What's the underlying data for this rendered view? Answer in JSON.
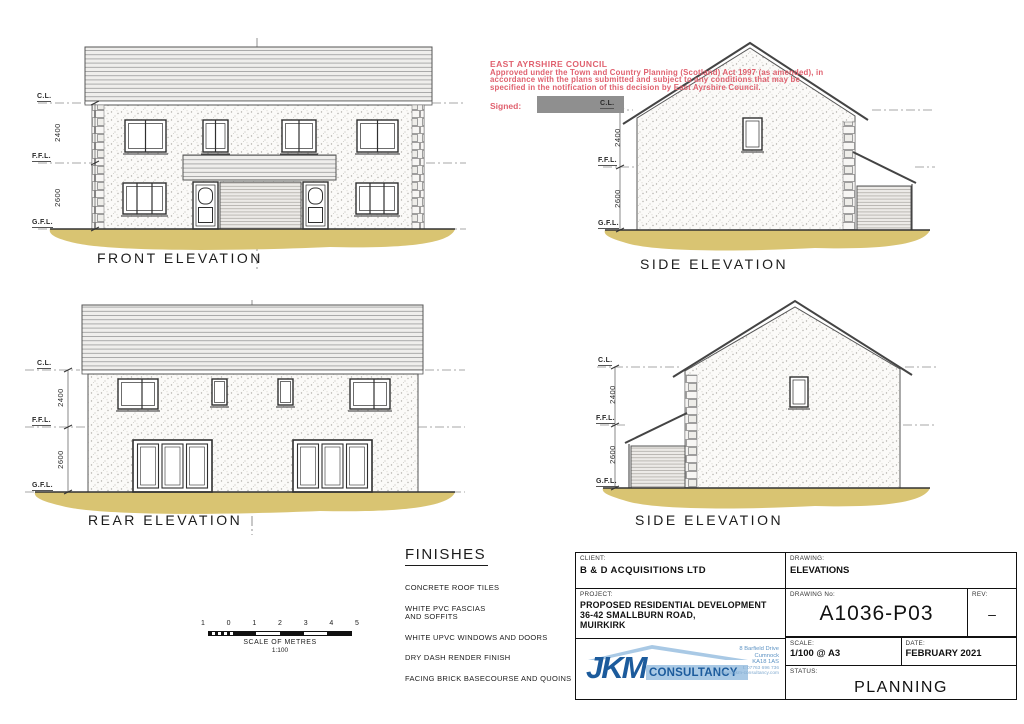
{
  "stamp": {
    "council": "EAST AYRSHIRE COUNCIL",
    "line1": "Approved under the Town and Country Planning (Scotland) Act 1997 (as amended), in",
    "line2": "accordance with the plans submitted and subject to any conditions that may be",
    "line3": "specified in the notification of this decision by East Ayrshire Council.",
    "signed_label": "Signed:"
  },
  "levels": {
    "cl": "C.L.",
    "ffl": "F.F.L.",
    "gfl": "G.F.L.",
    "dim_upper": "2400",
    "dim_lower": "2600"
  },
  "elevations": {
    "front": "FRONT ELEVATION",
    "side_top": "SIDE ELEVATION",
    "rear": "REAR ELEVATION",
    "side_bottom": "SIDE ELEVATION"
  },
  "finishes": {
    "title": "FINISHES",
    "items": [
      "CONCRETE ROOF TILES",
      "WHITE PVC FASCIAS\nAND SOFFITS",
      "WHITE UPVC WINDOWS AND DOORS",
      "DRY DASH RENDER FINISH",
      "FACING BRICK BASECOURSE AND QUOINS"
    ]
  },
  "scalebar": {
    "ticks": [
      "1",
      "0",
      "1",
      "2",
      "3",
      "4",
      "5"
    ],
    "caption": "SCALE OF METRES",
    "ratio": "1:100"
  },
  "titleblock": {
    "client_label": "CLIENT:",
    "client": "B & D ACQUISITIONS LTD",
    "drawing_label": "DRAWING:",
    "drawing": "ELEVATIONS",
    "project_label": "PROJECT:",
    "project_line1": "PROPOSED RESIDENTIAL DEVELOPMENT",
    "project_line2": "36-42 SMALLBURN ROAD,",
    "project_line3": "MUIRKIRK",
    "drawing_no_label": "DRAWING No:",
    "drawing_no": "A1036-P03",
    "rev_label": "REV:",
    "rev": "–",
    "scale_label": "SCALE:",
    "scale": "1/100 @ A3",
    "date_label": "DATE:",
    "date": "FEBRUARY 2021",
    "status_label": "STATUS:",
    "status": "PLANNING",
    "logo": {
      "jkm": "JKM",
      "consultancy": "CONSULTANCY",
      "addr1": "8 Barfield Drive",
      "addr2": "Cumnock",
      "addr3": "KA18 1AS",
      "addr4": "t: 07763 696 736",
      "addr5": "e: mail@jkm-consultancy.com"
    }
  },
  "colors": {
    "ground": "#d9c472",
    "stamp_red": "#e0616f",
    "redact_grey": "#8f8f8f",
    "logo_dark": "#1c5b9c",
    "logo_light": "#a9c9e5"
  }
}
